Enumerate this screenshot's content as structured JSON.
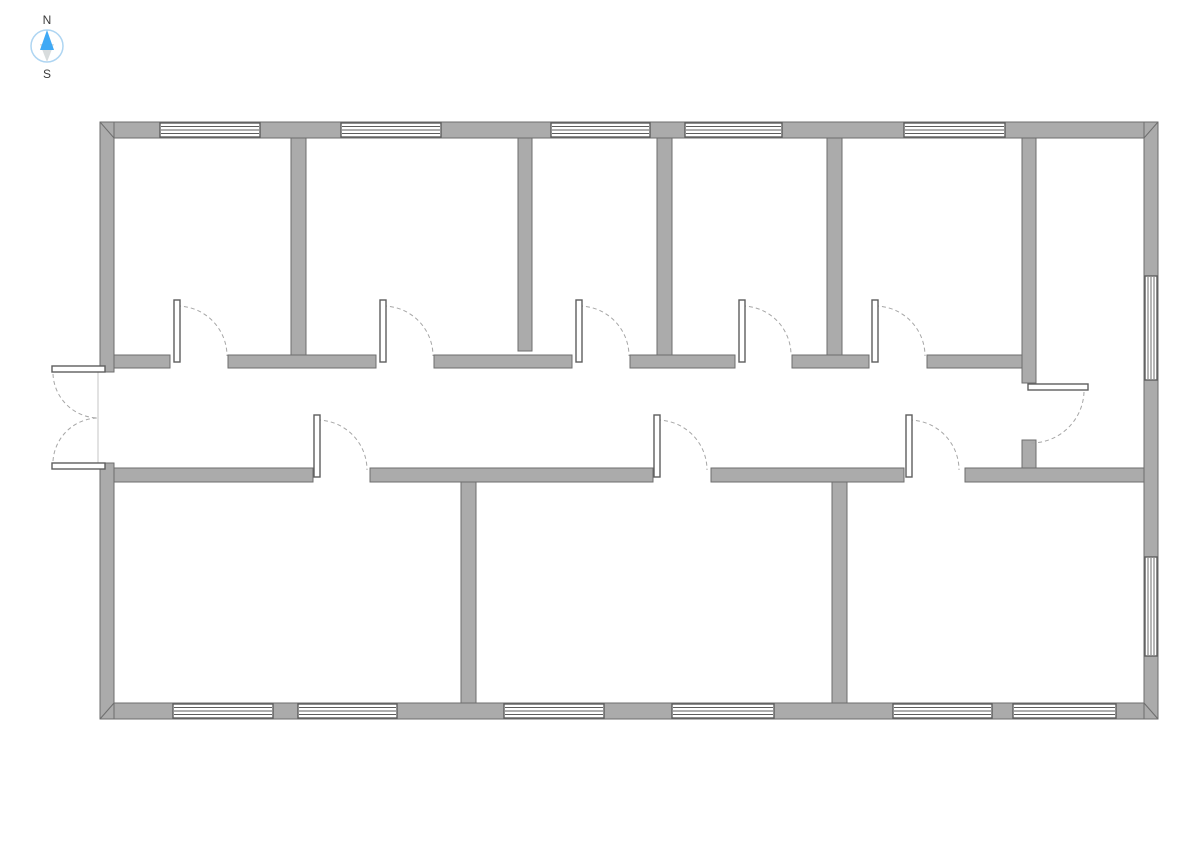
{
  "compass": {
    "north_label": "N",
    "south_label": "S"
  },
  "plan": {
    "canvas": {
      "width": 1191,
      "height": 842,
      "background": "#ffffff"
    },
    "palette": {
      "wall_fill": "#ababab",
      "wall_stroke": "#6e6e6e",
      "window_fill": "#ffffff",
      "window_stroke": "#5d5d5d",
      "door_leaf_fill": "#ffffff",
      "door_leaf_stroke": "#5d5d5d",
      "swing_arc": "#a6a6a6",
      "threshold_line": "#c4c4c4",
      "compass_north_fill": "#3fa9f5",
      "compass_south_fill": "#d8dcdd",
      "compass_ring": "#aed5f2",
      "compass_text": "#3a3a3a"
    },
    "walls": [
      {
        "id": "exterior-top",
        "x": 100,
        "y": 122,
        "w": 1058,
        "h": 16
      },
      {
        "id": "exterior-bottom",
        "x": 100,
        "y": 703,
        "w": 1058,
        "h": 16
      },
      {
        "id": "exterior-left-upper",
        "x": 100,
        "y": 122,
        "w": 14,
        "h": 250
      },
      {
        "id": "exterior-left-lower",
        "x": 100,
        "y": 463,
        "w": 14,
        "h": 256
      },
      {
        "id": "exterior-right",
        "x": 1144,
        "y": 122,
        "w": 14,
        "h": 597
      },
      {
        "id": "corridor-north-seg-1",
        "x": 114,
        "y": 355,
        "w": 56,
        "h": 13
      },
      {
        "id": "corridor-north-seg-2",
        "x": 228,
        "y": 355,
        "w": 148,
        "h": 13
      },
      {
        "id": "corridor-north-seg-3",
        "x": 434,
        "y": 355,
        "w": 138,
        "h": 13
      },
      {
        "id": "corridor-north-seg-4",
        "x": 630,
        "y": 355,
        "w": 105,
        "h": 13
      },
      {
        "id": "corridor-north-seg-5",
        "x": 792,
        "y": 355,
        "w": 77,
        "h": 13
      },
      {
        "id": "corridor-north-seg-6",
        "x": 927,
        "y": 355,
        "w": 95,
        "h": 13
      },
      {
        "id": "corridor-south-seg-1",
        "x": 114,
        "y": 468,
        "w": 199,
        "h": 14
      },
      {
        "id": "corridor-south-seg-2",
        "x": 370,
        "y": 468,
        "w": 283,
        "h": 14
      },
      {
        "id": "corridor-south-seg-3",
        "x": 711,
        "y": 468,
        "w": 193,
        "h": 14
      },
      {
        "id": "corridor-south-seg-4",
        "x": 965,
        "y": 468,
        "w": 179,
        "h": 14
      },
      {
        "id": "divider-top-rooms-1-2",
        "x": 291,
        "y": 138,
        "w": 15,
        "h": 217
      },
      {
        "id": "divider-top-rooms-2-3",
        "x": 518,
        "y": 138,
        "w": 14,
        "h": 213
      },
      {
        "id": "divider-top-rooms-3-4",
        "x": 657,
        "y": 138,
        "w": 15,
        "h": 217
      },
      {
        "id": "divider-top-rooms-4-5",
        "x": 827,
        "y": 138,
        "w": 15,
        "h": 217
      },
      {
        "id": "right-room-west-upper",
        "x": 1022,
        "y": 138,
        "w": 14,
        "h": 245
      },
      {
        "id": "right-room-west-lower",
        "x": 1022,
        "y": 440,
        "w": 14,
        "h": 28
      },
      {
        "id": "divider-bottom-rooms-1-2",
        "x": 461,
        "y": 482,
        "w": 15,
        "h": 221
      },
      {
        "id": "divider-bottom-rooms-2-3",
        "x": 832,
        "y": 482,
        "w": 15,
        "h": 221
      }
    ],
    "miter_lines": [
      {
        "x1": 100,
        "y1": 122,
        "x2": 114,
        "y2": 138
      },
      {
        "x1": 1158,
        "y1": 122,
        "x2": 1144,
        "y2": 138
      },
      {
        "x1": 100,
        "y1": 719,
        "x2": 114,
        "y2": 703
      },
      {
        "x1": 1158,
        "y1": 719,
        "x2": 1144,
        "y2": 703
      }
    ],
    "windows": [
      {
        "id": "north-window-1",
        "x": 160,
        "y": 123,
        "w": 100,
        "h": 14,
        "dir": "h"
      },
      {
        "id": "north-window-2",
        "x": 341,
        "y": 123,
        "w": 100,
        "h": 14,
        "dir": "h"
      },
      {
        "id": "north-window-3",
        "x": 551,
        "y": 123,
        "w": 99,
        "h": 14,
        "dir": "h"
      },
      {
        "id": "north-window-4",
        "x": 685,
        "y": 123,
        "w": 97,
        "h": 14,
        "dir": "h"
      },
      {
        "id": "north-window-5",
        "x": 904,
        "y": 123,
        "w": 101,
        "h": 14,
        "dir": "h"
      },
      {
        "id": "south-window-1",
        "x": 173,
        "y": 704,
        "w": 100,
        "h": 14,
        "dir": "h"
      },
      {
        "id": "south-window-2",
        "x": 298,
        "y": 704,
        "w": 99,
        "h": 14,
        "dir": "h"
      },
      {
        "id": "south-window-3",
        "x": 504,
        "y": 704,
        "w": 100,
        "h": 14,
        "dir": "h"
      },
      {
        "id": "south-window-4",
        "x": 672,
        "y": 704,
        "w": 102,
        "h": 14,
        "dir": "h"
      },
      {
        "id": "south-window-5",
        "x": 893,
        "y": 704,
        "w": 99,
        "h": 14,
        "dir": "h"
      },
      {
        "id": "south-window-6",
        "x": 1013,
        "y": 704,
        "w": 103,
        "h": 14,
        "dir": "h"
      },
      {
        "id": "east-window-1",
        "x": 1145,
        "y": 276,
        "w": 12,
        "h": 104,
        "dir": "v"
      },
      {
        "id": "east-window-2",
        "x": 1145,
        "y": 557,
        "w": 12,
        "h": 99,
        "dir": "v"
      }
    ],
    "doors": [
      {
        "id": "top-room-1-door",
        "leaves": [
          {
            "x": 174,
            "y": 300,
            "w": 6,
            "h": 62
          }
        ],
        "arcs": [
          "M 177,306 A 50 50 0 0 1 227,356"
        ]
      },
      {
        "id": "top-room-2-door",
        "leaves": [
          {
            "x": 380,
            "y": 300,
            "w": 6,
            "h": 62
          }
        ],
        "arcs": [
          "M 383,306 A 50 50 0 0 1 433,356"
        ]
      },
      {
        "id": "top-room-3-door",
        "leaves": [
          {
            "x": 576,
            "y": 300,
            "w": 6,
            "h": 62
          }
        ],
        "arcs": [
          "M 579,306 A 50 50 0 0 1 629,356"
        ]
      },
      {
        "id": "top-room-4-door",
        "leaves": [
          {
            "x": 739,
            "y": 300,
            "w": 6,
            "h": 62
          }
        ],
        "arcs": [
          "M 742,306 A 49 49 0 0 1 791,355"
        ]
      },
      {
        "id": "top-room-5-door",
        "leaves": [
          {
            "x": 872,
            "y": 300,
            "w": 6,
            "h": 62
          }
        ],
        "arcs": [
          "M 875,306 A 50 50 0 0 1 925,356"
        ]
      },
      {
        "id": "bottom-room-1-door",
        "leaves": [
          {
            "x": 314,
            "y": 415,
            "w": 6,
            "h": 62
          }
        ],
        "arcs": [
          "M 317,420 A 50 50 0 0 1 367,470"
        ]
      },
      {
        "id": "bottom-room-2-door",
        "leaves": [
          {
            "x": 654,
            "y": 415,
            "w": 6,
            "h": 62
          }
        ],
        "arcs": [
          "M 657,420 A 50 50 0 0 1 707,470"
        ]
      },
      {
        "id": "bottom-room-3-door",
        "leaves": [
          {
            "x": 906,
            "y": 415,
            "w": 6,
            "h": 62
          }
        ],
        "arcs": [
          "M 909,420 A 50 50 0 0 1 959,470"
        ]
      },
      {
        "id": "right-room-door",
        "leaves": [
          {
            "x": 1028,
            "y": 384,
            "w": 60,
            "h": 6
          }
        ],
        "arcs": [
          "M 1084,392 A 53 53 0 0 1 1031,443"
        ]
      },
      {
        "id": "entrance-double-door",
        "leaves": [
          {
            "x": 52,
            "y": 366,
            "w": 53,
            "h": 6
          },
          {
            "x": 52,
            "y": 463,
            "w": 53,
            "h": 6
          }
        ],
        "arcs": [
          "M 53,374 A 46 46 0 0 0 98,418",
          "M 53,461 A 46 46 0 0 1 98,418"
        ],
        "lines": [
          {
            "x1": 98,
            "y1": 372,
            "x2": 98,
            "y2": 463
          }
        ]
      }
    ]
  }
}
